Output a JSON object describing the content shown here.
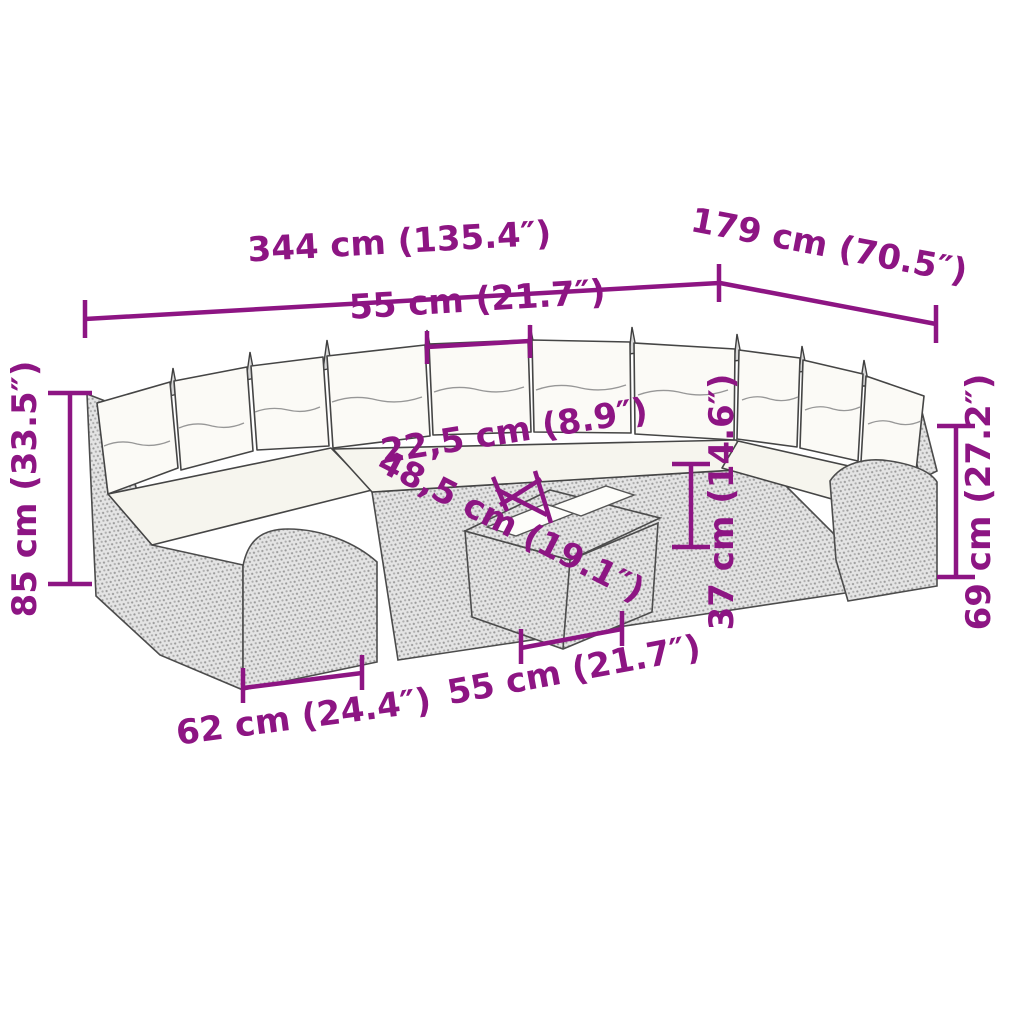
{
  "figure": {
    "type": "product-dimension-diagram",
    "subject": "rattan garden sofa set with cushions and coffee table",
    "style": "line-art illustration with wicker dot texture"
  },
  "colors": {
    "dimension_accent": "#8d1583",
    "outline": "#4c4c4c",
    "wicker_fill": "#e4e4e4",
    "cushion_fill": "#fbfaf6",
    "background": "#ffffff"
  },
  "dimensions": {
    "total_width": "344 cm (135.4″)",
    "total_depth": "179 cm (70.5″)",
    "seat_width_top": "55 cm (21.7″)",
    "total_height": "85 cm (33.5″)",
    "cushion_height": "22,5 cm (8.9″)",
    "table_depth_diagonal": "48,5 cm (19.1″)",
    "seat_height": "37 cm (14.6″)",
    "arm_back_height": "69 cm (27.2″)",
    "table_length": "55 cm (21.7″)",
    "module_depth": "62 cm (24.4″)"
  }
}
